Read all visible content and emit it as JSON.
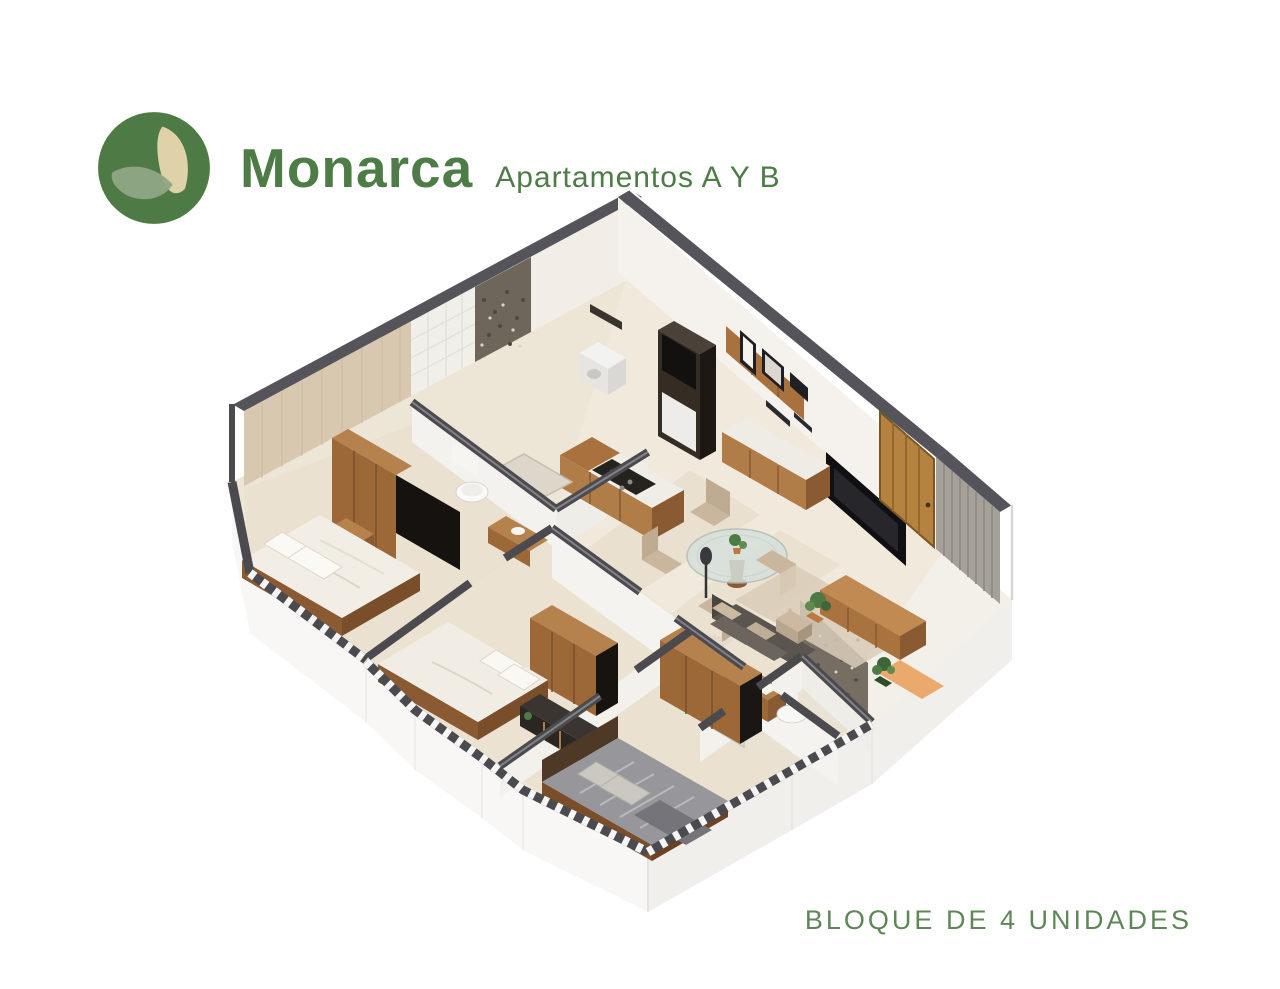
{
  "header": {
    "brand": "Monarca",
    "subtitle": "Apartamentos A Y B",
    "text_color": "#4d7c46",
    "logo": {
      "icon": "monarca-leaf-logo",
      "circle_color": "#4e7b45",
      "left_leaf_color": "#90a584",
      "right_leaf_color": "#dfd2a8"
    }
  },
  "footer": {
    "caption": "BLOQUE DE 4 UNIDADES",
    "color": "#5e8758"
  },
  "floorplan": {
    "kind": "isometric-3d-apartment-render",
    "rooms": [
      "bedroom-1",
      "bathroom-1",
      "kitchen",
      "laundry-nook",
      "dining-area",
      "living-area",
      "bedroom-2",
      "bedroom-3",
      "bathroom-2",
      "entry-corridor"
    ],
    "palette": {
      "floor": "#ede5d6",
      "slab": "#f7f6f4",
      "wall_cap": "#4a4a4f",
      "wall_face": "#f5f2ed",
      "accent_wall": "#d7c8af",
      "mosaic": "#6f665b",
      "wood_light": "#b5824e",
      "wood_mid": "#9c6838",
      "wood_dark": "#7a4e2b",
      "dark_unit": "#2e2722",
      "duvet_white": "#f2eee5",
      "duvet_gray": "#97969b",
      "sofa": "#57524d",
      "rug": "#d9cdb8",
      "door_wood": "#b5823f",
      "slat_wall": "#a6a198",
      "glass": "#d7e0db",
      "mat_orange": "#e9a566",
      "plant_green": "#4e7a44"
    }
  }
}
